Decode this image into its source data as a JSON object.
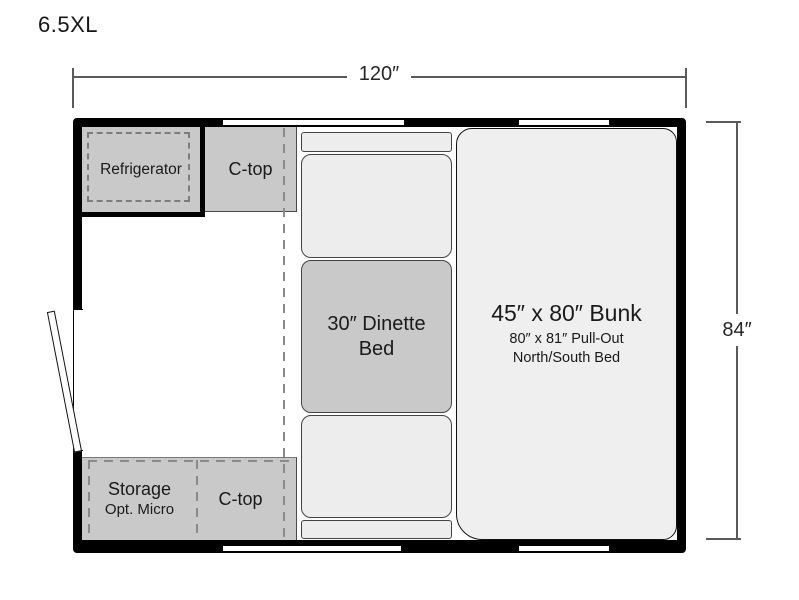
{
  "title": "6.5XL",
  "dimensions": {
    "width": "120″",
    "height": "84″"
  },
  "fixtures": {
    "refrigerator": "Refrigerator",
    "counter_top": "C-top",
    "dinette_line1": "30″ Dinette",
    "dinette_line2": "Bed",
    "bunk_title": "45″ x 80″ Bunk",
    "bunk_sub1": "80″ x 81″ Pull-Out",
    "bunk_sub2": "North/South Bed",
    "storage_line1": "Storage",
    "storage_line2": "Opt. Micro",
    "counter_top_bottom": "C-top"
  },
  "colors": {
    "wall": "#000000",
    "cabinet_fill": "#c9c9c9",
    "cushion_fill": "#ededed",
    "bunk_fill": "#efefef",
    "dashed_line": "#8a8a8a",
    "dimension_line": "#5a5a5a",
    "text": "#1a1a1a",
    "background": "#ffffff"
  }
}
